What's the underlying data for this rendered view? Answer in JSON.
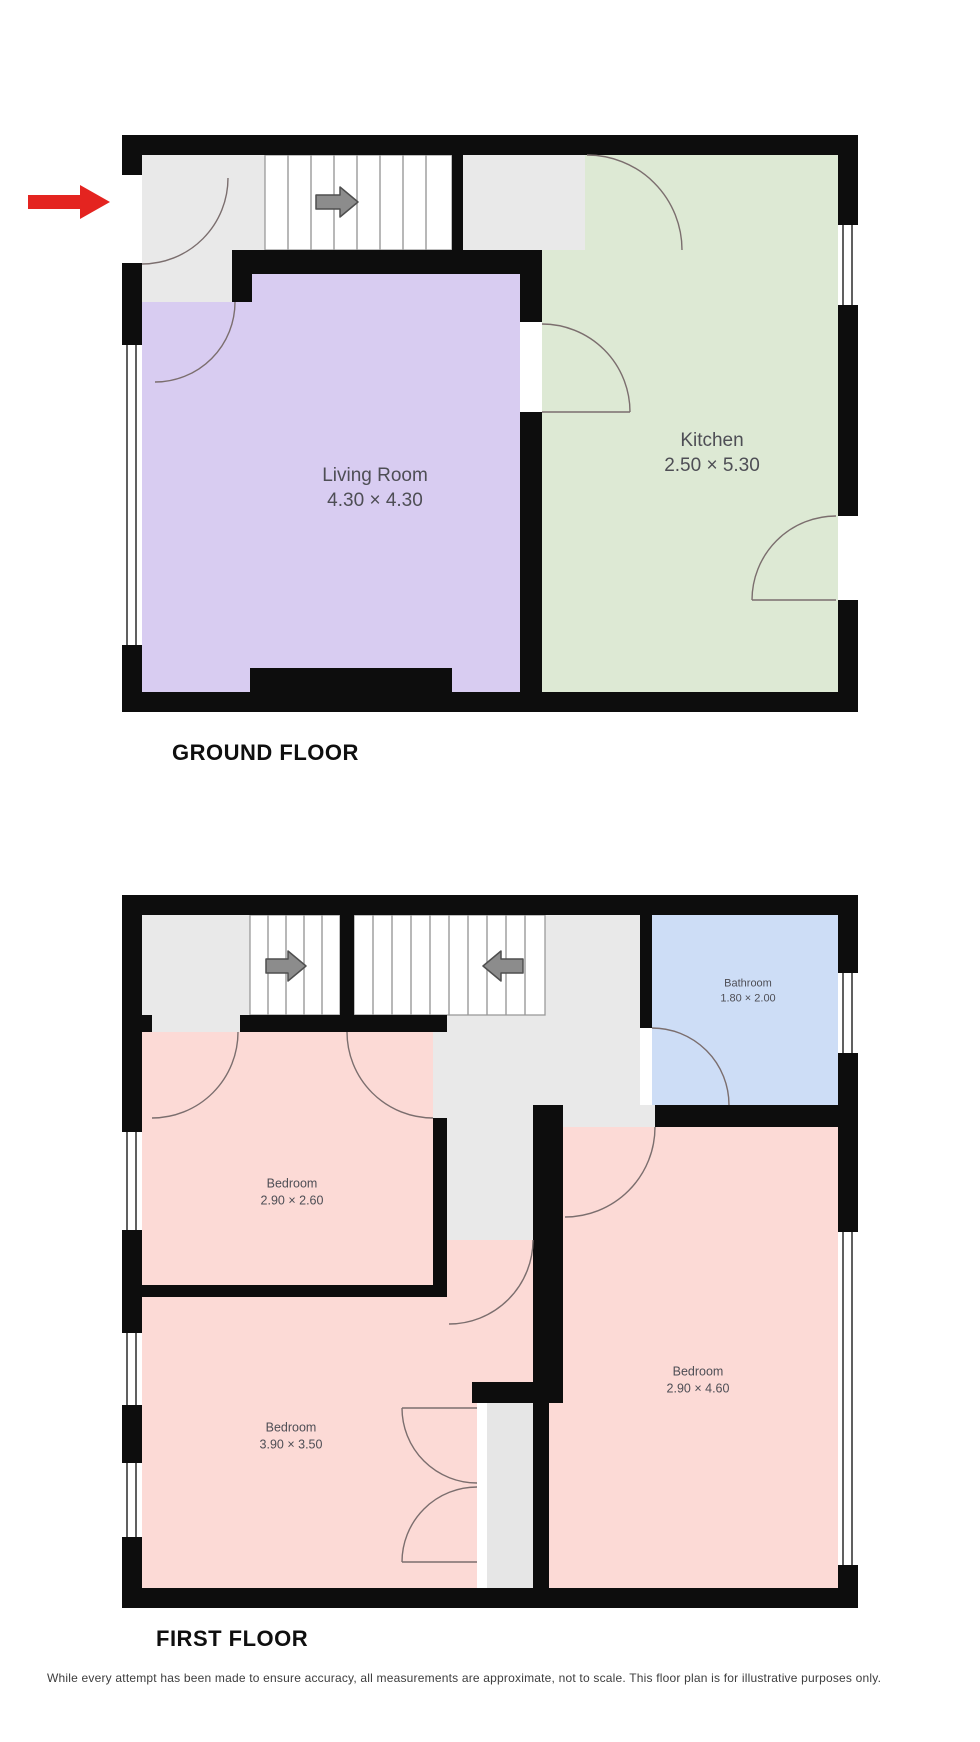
{
  "floors": [
    {
      "label": "GROUND FLOOR",
      "rooms": [
        {
          "name": "Living Room",
          "dimensions": "4.30 × 4.30"
        },
        {
          "name": "Kitchen",
          "dimensions": "2.50 × 5.30"
        }
      ]
    },
    {
      "label": "FIRST FLOOR",
      "rooms": [
        {
          "name": "Bedroom",
          "dimensions": "2.90 × 2.60"
        },
        {
          "name": "Bedroom",
          "dimensions": "3.90 × 3.50"
        },
        {
          "name": "Bedroom",
          "dimensions": "2.90 × 4.60"
        },
        {
          "name": "Bathroom",
          "dimensions": "1.80 × 2.00"
        }
      ]
    }
  ],
  "disclaimer": "While every attempt has been made to ensure accuracy, all measurements are approximate, not to scale. This floor plan is for illustrative purposes only.",
  "colors": {
    "living_room": "#d8ccf1",
    "kitchen": "#dde9d4",
    "bedroom": "#fcdad6",
    "bathroom": "#cdddf6",
    "landing": "#e9e9e9",
    "closet": "#e6e6e6",
    "wall": "#0d0d0d",
    "stair_arrow": "#8c8c8c",
    "entrance_arrow": "#e42420"
  }
}
